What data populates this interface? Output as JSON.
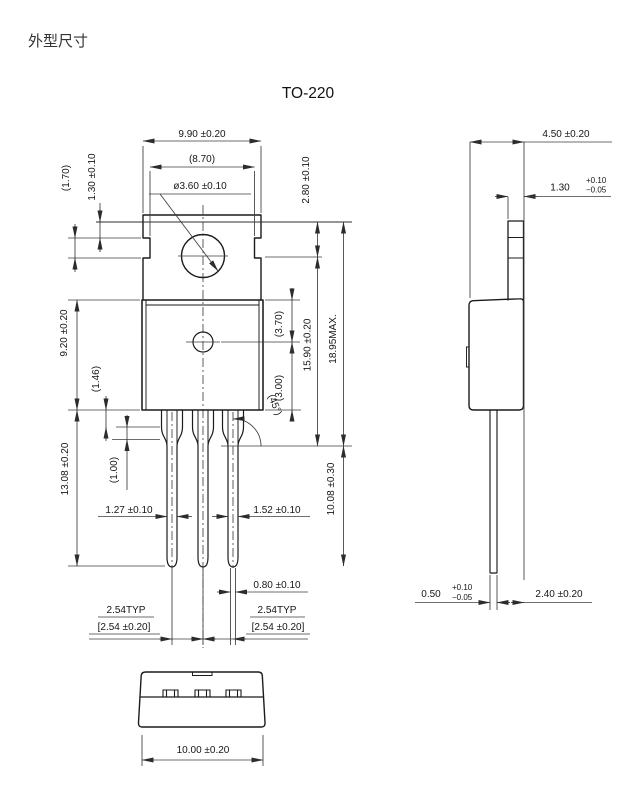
{
  "page": {
    "title": "外型尺寸",
    "package_name": "TO-220"
  },
  "colors": {
    "background": "#ffffff",
    "outline": "#1b1b1b",
    "dimension_lines": "#3d3d3d",
    "text": "#161616"
  },
  "front": {
    "overall_width": "9.90 ±0.20",
    "hole_flat_width": "(8.70)",
    "hole_diameter": "ø3.60 ±0.10",
    "ear_height": "(1.70)",
    "top_to_ear": "1.30 ±0.10",
    "top_to_ear_bottom": "2.80 ±0.10",
    "body_height": "9.20 ±0.20",
    "shoulder_step1": "(1.46)",
    "shoulder_step2": "(1.00)",
    "body_top_to_center": "(3.70)",
    "center_offset": "(3.00)",
    "ear_to_shoulder": "15.90 ±0.20",
    "overall_height": "18.95MAX.",
    "chamfer_angle": "(45°)",
    "lead_width_outer": "1.27 ±0.10",
    "lead_width_right": "1.52 ±0.10",
    "body_to_lead_tip": "13.08 ±0.20",
    "shoulder_to_lead_tip": "10.08 ±0.30",
    "lead_tip_width": "0.80 ±0.10",
    "pitch_left_typ": "2.54TYP",
    "pitch_left_tol": "[2.54 ±0.20]",
    "pitch_right_typ": "2.54TYP",
    "pitch_right_tol": "[2.54 ±0.20]"
  },
  "side": {
    "overall_depth": "4.50 ±0.20",
    "tab_thickness": {
      "value": "1.30",
      "tol_plus": "+0.10",
      "tol_minus": "−0.05"
    },
    "lead_thickness": {
      "value": "0.50",
      "tol_plus": "+0.10",
      "tol_minus": "−0.05"
    },
    "lead_to_back": "2.40 ±0.20"
  },
  "bottom": {
    "overall_width": "10.00 ±0.20"
  }
}
